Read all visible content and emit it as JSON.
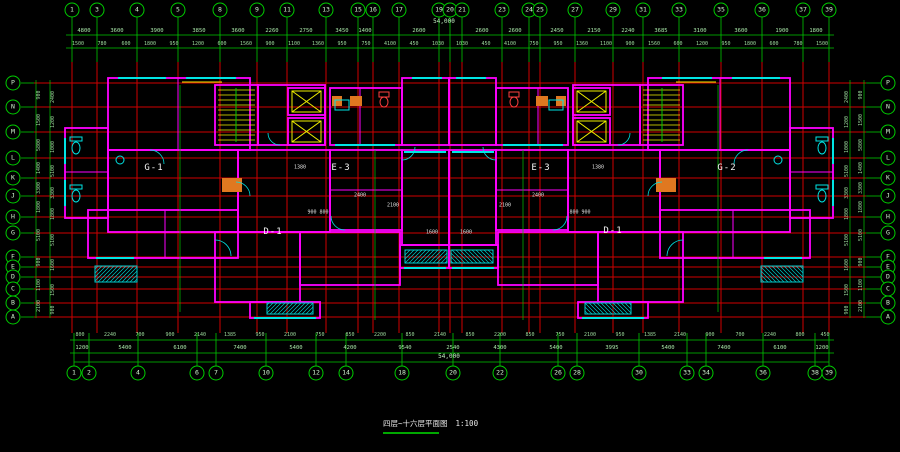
{
  "caption": {
    "title": "四层~十六层平面图",
    "scale": "1:100"
  },
  "unit_labels": [
    {
      "x": 154,
      "y": 168,
      "label": "G-1"
    },
    {
      "x": 341,
      "y": 168,
      "label": "E-3"
    },
    {
      "x": 541,
      "y": 168,
      "label": "E-3"
    },
    {
      "x": 727,
      "y": 168,
      "label": "G-2"
    },
    {
      "x": 273,
      "y": 232,
      "label": "D-1"
    },
    {
      "x": 613,
      "y": 231,
      "label": "D-1"
    }
  ],
  "axes": {
    "top_bubbles": [
      {
        "label": "1",
        "x": 72,
        "y": 10
      },
      {
        "label": "3",
        "x": 97,
        "y": 10
      },
      {
        "label": "4",
        "x": 137,
        "y": 10
      },
      {
        "label": "5",
        "x": 178,
        "y": 10
      },
      {
        "label": "8",
        "x": 220,
        "y": 10
      },
      {
        "label": "9",
        "x": 257,
        "y": 10
      },
      {
        "label": "11",
        "x": 287,
        "y": 10
      },
      {
        "label": "13",
        "x": 326,
        "y": 10
      },
      {
        "label": "15",
        "x": 358,
        "y": 10
      },
      {
        "label": "16",
        "x": 373,
        "y": 10
      },
      {
        "label": "17",
        "x": 399,
        "y": 10
      },
      {
        "label": "19",
        "x": 439,
        "y": 10
      },
      {
        "label": "20",
        "x": 450,
        "y": 10
      },
      {
        "label": "21",
        "x": 462,
        "y": 10
      },
      {
        "label": "23",
        "x": 502,
        "y": 10
      },
      {
        "label": "24",
        "x": 529,
        "y": 10
      },
      {
        "label": "25",
        "x": 540,
        "y": 10
      },
      {
        "label": "27",
        "x": 575,
        "y": 10
      },
      {
        "label": "29",
        "x": 613,
        "y": 10
      },
      {
        "label": "31",
        "x": 643,
        "y": 10
      },
      {
        "label": "33",
        "x": 679,
        "y": 10
      },
      {
        "label": "35",
        "x": 721,
        "y": 10
      },
      {
        "label": "36",
        "x": 762,
        "y": 10
      },
      {
        "label": "37",
        "x": 803,
        "y": 10
      },
      {
        "label": "39",
        "x": 829,
        "y": 10
      }
    ],
    "bottom_bubbles": [
      {
        "label": "1",
        "x": 74,
        "y": 373
      },
      {
        "label": "2",
        "x": 89,
        "y": 373
      },
      {
        "label": "4",
        "x": 138,
        "y": 373
      },
      {
        "label": "6",
        "x": 197,
        "y": 373
      },
      {
        "label": "7",
        "x": 216,
        "y": 373
      },
      {
        "label": "10",
        "x": 266,
        "y": 373
      },
      {
        "label": "12",
        "x": 316,
        "y": 373
      },
      {
        "label": "14",
        "x": 346,
        "y": 373
      },
      {
        "label": "18",
        "x": 402,
        "y": 373
      },
      {
        "label": "20",
        "x": 453,
        "y": 373
      },
      {
        "label": "22",
        "x": 500,
        "y": 373
      },
      {
        "label": "26",
        "x": 558,
        "y": 373
      },
      {
        "label": "28",
        "x": 577,
        "y": 373
      },
      {
        "label": "30",
        "x": 639,
        "y": 373
      },
      {
        "label": "33",
        "x": 687,
        "y": 373
      },
      {
        "label": "34",
        "x": 706,
        "y": 373
      },
      {
        "label": "36",
        "x": 763,
        "y": 373
      },
      {
        "label": "38",
        "x": 815,
        "y": 373
      },
      {
        "label": "39",
        "x": 829,
        "y": 373
      }
    ],
    "left_bubbles": [
      {
        "label": "P",
        "x": 13,
        "y": 83
      },
      {
        "label": "N",
        "x": 13,
        "y": 107
      },
      {
        "label": "M",
        "x": 13,
        "y": 132
      },
      {
        "label": "L",
        "x": 13,
        "y": 158
      },
      {
        "label": "K",
        "x": 13,
        "y": 178
      },
      {
        "label": "J",
        "x": 13,
        "y": 196
      },
      {
        "label": "H",
        "x": 13,
        "y": 217
      },
      {
        "label": "G",
        "x": 13,
        "y": 233
      },
      {
        "label": "F",
        "x": 13,
        "y": 257
      },
      {
        "label": "E",
        "x": 13,
        "y": 267
      },
      {
        "label": "D",
        "x": 13,
        "y": 277
      },
      {
        "label": "C",
        "x": 13,
        "y": 289
      },
      {
        "label": "B",
        "x": 13,
        "y": 303
      },
      {
        "label": "A",
        "x": 13,
        "y": 317
      }
    ],
    "right_bubbles": [
      {
        "label": "P",
        "x": 888,
        "y": 83
      },
      {
        "label": "N",
        "x": 888,
        "y": 107
      },
      {
        "label": "M",
        "x": 888,
        "y": 132
      },
      {
        "label": "L",
        "x": 888,
        "y": 158
      },
      {
        "label": "K",
        "x": 888,
        "y": 178
      },
      {
        "label": "J",
        "x": 888,
        "y": 196
      },
      {
        "label": "H",
        "x": 888,
        "y": 217
      },
      {
        "label": "G",
        "x": 888,
        "y": 233
      },
      {
        "label": "F",
        "x": 888,
        "y": 257
      },
      {
        "label": "E",
        "x": 888,
        "y": 267
      },
      {
        "label": "D",
        "x": 888,
        "y": 277
      },
      {
        "label": "C",
        "x": 888,
        "y": 289
      },
      {
        "label": "B",
        "x": 888,
        "y": 303
      },
      {
        "label": "A",
        "x": 888,
        "y": 317
      }
    ]
  },
  "dimensions": {
    "top_total": [
      {
        "x": 444,
        "y": 22,
        "label": "54,000",
        "cls": "total"
      }
    ],
    "top_row1": [
      {
        "x": 84,
        "y": 31,
        "label": "4800"
      },
      {
        "x": 117,
        "y": 31,
        "label": "3600"
      },
      {
        "x": 157,
        "y": 31,
        "label": "3900"
      },
      {
        "x": 199,
        "y": 31,
        "label": "3850"
      },
      {
        "x": 238,
        "y": 31,
        "label": "3600"
      },
      {
        "x": 272,
        "y": 31,
        "label": "2260"
      },
      {
        "x": 306,
        "y": 31,
        "label": "2750"
      },
      {
        "x": 342,
        "y": 31,
        "label": "3450"
      },
      {
        "x": 365,
        "y": 31,
        "label": "1400"
      },
      {
        "x": 419,
        "y": 31,
        "label": "2600"
      },
      {
        "x": 482,
        "y": 31,
        "label": "2600"
      },
      {
        "x": 515,
        "y": 31,
        "label": "2600"
      },
      {
        "x": 557,
        "y": 31,
        "label": "2450"
      },
      {
        "x": 594,
        "y": 31,
        "label": "2150"
      },
      {
        "x": 628,
        "y": 31,
        "label": "2240"
      },
      {
        "x": 661,
        "y": 31,
        "label": "3685"
      },
      {
        "x": 700,
        "y": 31,
        "label": "3100"
      },
      {
        "x": 741,
        "y": 31,
        "label": "3600"
      },
      {
        "x": 782,
        "y": 31,
        "label": "1900"
      },
      {
        "x": 816,
        "y": 31,
        "label": "1800"
      }
    ],
    "top_row2": [
      {
        "x": 78,
        "y": 44,
        "label": "1500",
        "cls": "tiny"
      },
      {
        "x": 102,
        "y": 44,
        "label": "780",
        "cls": "tiny"
      },
      {
        "x": 126,
        "y": 44,
        "label": "600",
        "cls": "tiny"
      },
      {
        "x": 150,
        "y": 44,
        "label": "1800",
        "cls": "tiny"
      },
      {
        "x": 174,
        "y": 44,
        "label": "950",
        "cls": "tiny"
      },
      {
        "x": 198,
        "y": 44,
        "label": "1200",
        "cls": "tiny"
      },
      {
        "x": 222,
        "y": 44,
        "label": "600",
        "cls": "tiny"
      },
      {
        "x": 246,
        "y": 44,
        "label": "1560",
        "cls": "tiny"
      },
      {
        "x": 270,
        "y": 44,
        "label": "900",
        "cls": "tiny"
      },
      {
        "x": 294,
        "y": 44,
        "label": "1100",
        "cls": "tiny"
      },
      {
        "x": 318,
        "y": 44,
        "label": "1360",
        "cls": "tiny"
      },
      {
        "x": 342,
        "y": 44,
        "label": "950",
        "cls": "tiny"
      },
      {
        "x": 366,
        "y": 44,
        "label": "750",
        "cls": "tiny"
      },
      {
        "x": 390,
        "y": 44,
        "label": "4100",
        "cls": "tiny"
      },
      {
        "x": 414,
        "y": 44,
        "label": "450",
        "cls": "tiny"
      },
      {
        "x": 438,
        "y": 44,
        "label": "1030",
        "cls": "tiny"
      },
      {
        "x": 462,
        "y": 44,
        "label": "1030",
        "cls": "tiny"
      },
      {
        "x": 486,
        "y": 44,
        "label": "450",
        "cls": "tiny"
      },
      {
        "x": 510,
        "y": 44,
        "label": "4100",
        "cls": "tiny"
      },
      {
        "x": 534,
        "y": 44,
        "label": "750",
        "cls": "tiny"
      },
      {
        "x": 558,
        "y": 44,
        "label": "950",
        "cls": "tiny"
      },
      {
        "x": 582,
        "y": 44,
        "label": "1360",
        "cls": "tiny"
      },
      {
        "x": 606,
        "y": 44,
        "label": "1100",
        "cls": "tiny"
      },
      {
        "x": 630,
        "y": 44,
        "label": "900",
        "cls": "tiny"
      },
      {
        "x": 654,
        "y": 44,
        "label": "1560",
        "cls": "tiny"
      },
      {
        "x": 678,
        "y": 44,
        "label": "600",
        "cls": "tiny"
      },
      {
        "x": 702,
        "y": 44,
        "label": "1200",
        "cls": "tiny"
      },
      {
        "x": 726,
        "y": 44,
        "label": "950",
        "cls": "tiny"
      },
      {
        "x": 750,
        "y": 44,
        "label": "1800",
        "cls": "tiny"
      },
      {
        "x": 774,
        "y": 44,
        "label": "600",
        "cls": "tiny"
      },
      {
        "x": 798,
        "y": 44,
        "label": "780",
        "cls": "tiny"
      },
      {
        "x": 822,
        "y": 44,
        "label": "1500",
        "cls": "tiny"
      }
    ],
    "bottom_row_small": [
      {
        "x": 80,
        "y": 335,
        "label": "800",
        "cls": "tiny"
      },
      {
        "x": 110,
        "y": 335,
        "label": "2240",
        "cls": "tiny"
      },
      {
        "x": 140,
        "y": 335,
        "label": "700",
        "cls": "tiny"
      },
      {
        "x": 170,
        "y": 335,
        "label": "900",
        "cls": "tiny"
      },
      {
        "x": 200,
        "y": 335,
        "label": "2140",
        "cls": "tiny"
      },
      {
        "x": 230,
        "y": 335,
        "label": "1385",
        "cls": "tiny"
      },
      {
        "x": 260,
        "y": 335,
        "label": "950",
        "cls": "tiny"
      },
      {
        "x": 290,
        "y": 335,
        "label": "2100",
        "cls": "tiny"
      },
      {
        "x": 320,
        "y": 335,
        "label": "750",
        "cls": "tiny"
      },
      {
        "x": 350,
        "y": 335,
        "label": "850",
        "cls": "tiny"
      },
      {
        "x": 380,
        "y": 335,
        "label": "2200",
        "cls": "tiny"
      },
      {
        "x": 410,
        "y": 335,
        "label": "850",
        "cls": "tiny"
      },
      {
        "x": 440,
        "y": 335,
        "label": "2140",
        "cls": "tiny"
      },
      {
        "x": 470,
        "y": 335,
        "label": "850",
        "cls": "tiny"
      },
      {
        "x": 500,
        "y": 335,
        "label": "2200",
        "cls": "tiny"
      },
      {
        "x": 530,
        "y": 335,
        "label": "850",
        "cls": "tiny"
      },
      {
        "x": 560,
        "y": 335,
        "label": "750",
        "cls": "tiny"
      },
      {
        "x": 590,
        "y": 335,
        "label": "2100",
        "cls": "tiny"
      },
      {
        "x": 620,
        "y": 335,
        "label": "950",
        "cls": "tiny"
      },
      {
        "x": 650,
        "y": 335,
        "label": "1385",
        "cls": "tiny"
      },
      {
        "x": 680,
        "y": 335,
        "label": "2140",
        "cls": "tiny"
      },
      {
        "x": 710,
        "y": 335,
        "label": "900",
        "cls": "tiny"
      },
      {
        "x": 740,
        "y": 335,
        "label": "700",
        "cls": "tiny"
      },
      {
        "x": 770,
        "y": 335,
        "label": "2240",
        "cls": "tiny"
      },
      {
        "x": 800,
        "y": 335,
        "label": "800",
        "cls": "tiny"
      },
      {
        "x": 825,
        "y": 335,
        "label": "450",
        "cls": "tiny"
      }
    ],
    "bottom_row_big": [
      {
        "x": 82,
        "y": 348,
        "label": "1200"
      },
      {
        "x": 125,
        "y": 348,
        "label": "5400"
      },
      {
        "x": 180,
        "y": 348,
        "label": "6100"
      },
      {
        "x": 240,
        "y": 348,
        "label": "7400"
      },
      {
        "x": 296,
        "y": 348,
        "label": "5400"
      },
      {
        "x": 350,
        "y": 348,
        "label": "4200"
      },
      {
        "x": 405,
        "y": 348,
        "label": "9540"
      },
      {
        "x": 453,
        "y": 348,
        "label": "2540"
      },
      {
        "x": 500,
        "y": 348,
        "label": "4300"
      },
      {
        "x": 556,
        "y": 348,
        "label": "5400"
      },
      {
        "x": 612,
        "y": 348,
        "label": "3995"
      },
      {
        "x": 668,
        "y": 348,
        "label": "5400"
      },
      {
        "x": 724,
        "y": 348,
        "label": "7400"
      },
      {
        "x": 780,
        "y": 348,
        "label": "6100"
      },
      {
        "x": 822,
        "y": 348,
        "label": "1200"
      }
    ],
    "bottom_total": [
      {
        "x": 449,
        "y": 357,
        "label": "54,000",
        "cls": "total"
      }
    ],
    "left_col_outer": [
      {
        "x": 39,
        "y": 95,
        "label": "900",
        "cls": "v tiny"
      },
      {
        "x": 39,
        "y": 120,
        "label": "1500",
        "cls": "v tiny"
      },
      {
        "x": 39,
        "y": 145,
        "label": "5800",
        "cls": "v tiny"
      },
      {
        "x": 39,
        "y": 168,
        "label": "1400",
        "cls": "v tiny"
      },
      {
        "x": 39,
        "y": 188,
        "label": "3300",
        "cls": "v tiny"
      },
      {
        "x": 39,
        "y": 207,
        "label": "1800",
        "cls": "v tiny"
      },
      {
        "x": 39,
        "y": 235,
        "label": "5100",
        "cls": "v tiny"
      },
      {
        "x": 39,
        "y": 262,
        "label": "900",
        "cls": "v tiny"
      },
      {
        "x": 39,
        "y": 285,
        "label": "1100",
        "cls": "v tiny"
      },
      {
        "x": 39,
        "y": 306,
        "label": "2100",
        "cls": "v tiny"
      }
    ],
    "left_col_inner": [
      {
        "x": 53,
        "y": 97,
        "label": "2400",
        "cls": "v tiny"
      },
      {
        "x": 53,
        "y": 122,
        "label": "1200",
        "cls": "v tiny"
      },
      {
        "x": 53,
        "y": 147,
        "label": "1000",
        "cls": "v tiny"
      },
      {
        "x": 53,
        "y": 171,
        "label": "5100",
        "cls": "v tiny"
      },
      {
        "x": 53,
        "y": 193,
        "label": "3300",
        "cls": "v tiny"
      },
      {
        "x": 53,
        "y": 214,
        "label": "1800",
        "cls": "v tiny"
      },
      {
        "x": 53,
        "y": 240,
        "label": "5100",
        "cls": "v tiny"
      },
      {
        "x": 53,
        "y": 265,
        "label": "1600",
        "cls": "v tiny"
      },
      {
        "x": 53,
        "y": 290,
        "label": "1500",
        "cls": "v tiny"
      },
      {
        "x": 53,
        "y": 310,
        "label": "900",
        "cls": "v tiny"
      }
    ],
    "right_col_outer": [
      {
        "x": 861,
        "y": 95,
        "label": "900",
        "cls": "v tiny"
      },
      {
        "x": 861,
        "y": 120,
        "label": "1500",
        "cls": "v tiny"
      },
      {
        "x": 861,
        "y": 145,
        "label": "5800",
        "cls": "v tiny"
      },
      {
        "x": 861,
        "y": 168,
        "label": "1400",
        "cls": "v tiny"
      },
      {
        "x": 861,
        "y": 188,
        "label": "3300",
        "cls": "v tiny"
      },
      {
        "x": 861,
        "y": 207,
        "label": "1800",
        "cls": "v tiny"
      },
      {
        "x": 861,
        "y": 235,
        "label": "5100",
        "cls": "v tiny"
      },
      {
        "x": 861,
        "y": 262,
        "label": "900",
        "cls": "v tiny"
      },
      {
        "x": 861,
        "y": 285,
        "label": "1100",
        "cls": "v tiny"
      },
      {
        "x": 861,
        "y": 306,
        "label": "2100",
        "cls": "v tiny"
      }
    ],
    "right_col_inner": [
      {
        "x": 847,
        "y": 97,
        "label": "2400",
        "cls": "v tiny"
      },
      {
        "x": 847,
        "y": 122,
        "label": "1200",
        "cls": "v tiny"
      },
      {
        "x": 847,
        "y": 147,
        "label": "1000",
        "cls": "v tiny"
      },
      {
        "x": 847,
        "y": 171,
        "label": "5100",
        "cls": "v tiny"
      },
      {
        "x": 847,
        "y": 193,
        "label": "3300",
        "cls": "v tiny"
      },
      {
        "x": 847,
        "y": 214,
        "label": "1800",
        "cls": "v tiny"
      },
      {
        "x": 847,
        "y": 240,
        "label": "5100",
        "cls": "v tiny"
      },
      {
        "x": 847,
        "y": 265,
        "label": "1600",
        "cls": "v tiny"
      },
      {
        "x": 847,
        "y": 290,
        "label": "1500",
        "cls": "v tiny"
      },
      {
        "x": 847,
        "y": 310,
        "label": "900",
        "cls": "v tiny"
      }
    ],
    "interior": [
      {
        "x": 393,
        "y": 206,
        "label": "2100"
      },
      {
        "x": 505,
        "y": 206,
        "label": "2100"
      },
      {
        "x": 318,
        "y": 213,
        "label": "900 800"
      },
      {
        "x": 580,
        "y": 213,
        "label": "800 900"
      },
      {
        "x": 360,
        "y": 196,
        "label": "2400"
      },
      {
        "x": 538,
        "y": 196,
        "label": "2400"
      },
      {
        "x": 432,
        "y": 233,
        "label": "1600"
      },
      {
        "x": 466,
        "y": 233,
        "label": "1600"
      },
      {
        "x": 300,
        "y": 168,
        "label": "1380"
      },
      {
        "x": 598,
        "y": 168,
        "label": "1380"
      }
    ]
  },
  "colors": {
    "wall": "#ff00ff",
    "window": "#00e5e5",
    "axis_green": "#00c800",
    "grid_red": "#cf0000",
    "stair_yellow": "#f0f000",
    "kitchen_orange": "#e07820",
    "fixture_red": "#ff4040",
    "text": "#e8e8e8"
  }
}
